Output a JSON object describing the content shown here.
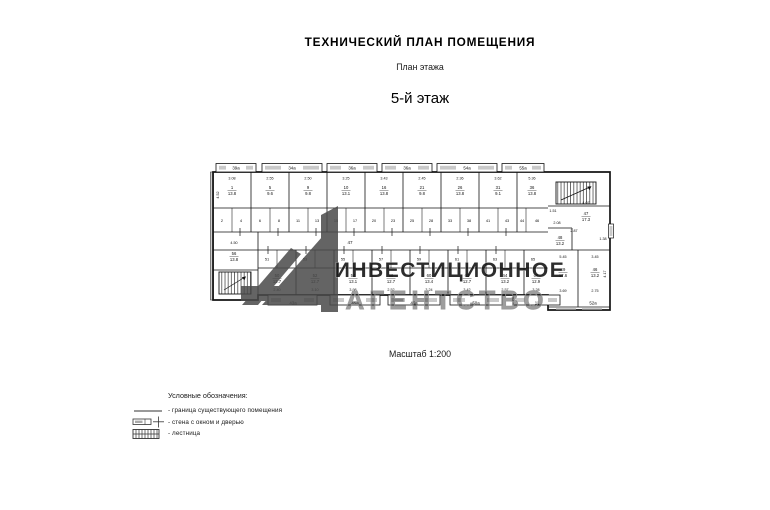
{
  "document": {
    "title": "ТЕХНИЧЕСКИЙ ПЛАН ПОМЕЩЕНИЯ",
    "subtitle": "План этажа",
    "floor_heading": "5-й этаж",
    "scale_note": "Масштаб 1:200"
  },
  "legend": {
    "heading": "Условные обозначения:",
    "items": [
      {
        "icon": "boundary-line-symbol",
        "label": "- граница существующего помещения"
      },
      {
        "icon": "wall-window-door-symbol",
        "label": "- стена с окном и дверью"
      },
      {
        "icon": "stairs-symbol",
        "label": "- лестница"
      }
    ]
  },
  "watermark": {
    "line1": "ИНВЕСТИЦИОННОЕ",
    "line2": "АГЕНТСТВО",
    "color": "#4a4a4a"
  },
  "plan": {
    "corridor_number": "47",
    "line_color": "#141414",
    "window_fill": "#c9c9c9",
    "edge_labels_top": [
      {
        "t": "39а",
        "x": 236
      },
      {
        "t": "34а",
        "x": 292
      },
      {
        "t": "36а",
        "x": 352
      },
      {
        "t": "36а",
        "x": 407
      },
      {
        "t": "54а",
        "x": 467
      },
      {
        "t": "55а",
        "x": 523
      }
    ],
    "edge_labels_bottom": [
      {
        "t": "43а",
        "x": 293
      },
      {
        "t": "45а",
        "x": 355
      },
      {
        "t": "46а",
        "x": 414
      },
      {
        "t": "50а",
        "x": 476
      },
      {
        "t": "11",
        "x": 537
      },
      {
        "t": "52а",
        "x": 593
      }
    ],
    "rooms_top": [
      {
        "n": "1",
        "a": "13.8",
        "x": 232
      },
      {
        "n": "5",
        "a": "9.6",
        "x": 270
      },
      {
        "n": "9",
        "a": "9.8",
        "x": 308
      },
      {
        "n": "10",
        "a": "13.1",
        "x": 346
      },
      {
        "n": "16",
        "a": "13.8",
        "x": 384
      },
      {
        "n": "21",
        "a": "9.8",
        "x": 422
      },
      {
        "n": "26",
        "a": "13.8",
        "x": 460
      },
      {
        "n": "31",
        "a": "9.1",
        "x": 498
      },
      {
        "n": "36",
        "a": "13.8",
        "x": 532
      }
    ],
    "rooms_bottom": [
      {
        "n": "50",
        "a": "12.7",
        "x": 277
      },
      {
        "n": "52",
        "a": "12.7",
        "x": 315
      },
      {
        "n": "54",
        "a": "13.1",
        "x": 353
      },
      {
        "n": "58",
        "a": "12.7",
        "x": 391
      },
      {
        "n": "60",
        "a": "13.4",
        "x": 429
      },
      {
        "n": "62",
        "a": "12.7",
        "x": 467
      },
      {
        "n": "64",
        "a": "13.2",
        "x": 505
      },
      {
        "n": "66",
        "a": "12.9",
        "x": 536
      }
    ],
    "left_rooms": [
      {
        "n": "56",
        "a": "13.8",
        "x": 234,
        "y": 256
      }
    ],
    "right_rooms": [
      {
        "n": "47",
        "a": "17.3",
        "x": 586,
        "y": 216
      },
      {
        "n": "48",
        "a": "13.2",
        "x": 560,
        "y": 240
      },
      {
        "n": "49",
        "a": "17.6",
        "x": 563,
        "y": 272
      },
      {
        "n": "46",
        "a": "13.2",
        "x": 595,
        "y": 272
      }
    ],
    "cells_top": [
      {
        "n": "2",
        "x": 222
      },
      {
        "n": "4",
        "x": 241
      },
      {
        "n": "6",
        "x": 260
      },
      {
        "n": "8",
        "x": 279
      },
      {
        "n": "11",
        "x": 298
      },
      {
        "n": "13",
        "x": 317
      },
      {
        "n": "15",
        "x": 336
      },
      {
        "n": "17",
        "x": 355
      },
      {
        "n": "20",
        "x": 374
      },
      {
        "n": "23",
        "x": 393
      },
      {
        "n": "25",
        "x": 412
      },
      {
        "n": "28",
        "x": 431
      },
      {
        "n": "33",
        "x": 450
      },
      {
        "n": "38",
        "x": 469
      },
      {
        "n": "41",
        "x": 488
      },
      {
        "n": "43",
        "x": 507
      },
      {
        "n": "44",
        "x": 522
      },
      {
        "n": "46",
        "x": 537
      }
    ],
    "cells_bottom": [
      {
        "n": "51",
        "x": 267
      },
      {
        "n": "53",
        "x": 305
      },
      {
        "n": "55",
        "x": 343
      },
      {
        "n": "57",
        "x": 381
      },
      {
        "n": "59",
        "x": 419
      },
      {
        "n": "61",
        "x": 457
      },
      {
        "n": "63",
        "x": 495
      },
      {
        "n": "65",
        "x": 533
      }
    ],
    "dims_top": [
      {
        "t": "3.08",
        "x": 232
      },
      {
        "t": "2.55",
        "x": 270
      },
      {
        "t": "2.50",
        "x": 308
      },
      {
        "t": "3.25",
        "x": 346
      },
      {
        "t": "3.43",
        "x": 384
      },
      {
        "t": "2.45",
        "x": 422
      },
      {
        "t": "2.36",
        "x": 460
      },
      {
        "t": "3.62",
        "x": 498
      },
      {
        "t": "5.36",
        "x": 532
      }
    ],
    "dims_bottom": [
      {
        "t": "2.40",
        "x": 277
      },
      {
        "t": "3.10",
        "x": 315
      },
      {
        "t": "3.98",
        "x": 353
      },
      {
        "t": "2.52",
        "x": 391
      },
      {
        "t": "3.24",
        "x": 429
      },
      {
        "t": "3.42",
        "x": 467
      },
      {
        "t": "2.57",
        "x": 505
      },
      {
        "t": "3.28",
        "x": 536
      }
    ],
    "dims_misc": [
      {
        "t": "4.50",
        "x": 234,
        "y": 244
      },
      {
        "t": "4.07",
        "x": 586,
        "y": 204
      },
      {
        "t": "1.51",
        "x": 553,
        "y": 212
      },
      {
        "t": "2.87",
        "x": 574,
        "y": 232
      },
      {
        "t": "2.08",
        "x": 557,
        "y": 224
      },
      {
        "t": "1.38",
        "x": 603,
        "y": 240
      },
      {
        "t": "5.45",
        "x": 563,
        "y": 258
      },
      {
        "t": "3.45",
        "x": 595,
        "y": 258
      },
      {
        "t": "3.69",
        "x": 563,
        "y": 292
      },
      {
        "t": "2.75",
        "x": 595,
        "y": 292
      },
      {
        "t": "4.52",
        "x": 219,
        "y": 195,
        "r": -90
      },
      {
        "t": "4.17",
        "x": 606,
        "y": 274,
        "r": -90
      }
    ]
  }
}
